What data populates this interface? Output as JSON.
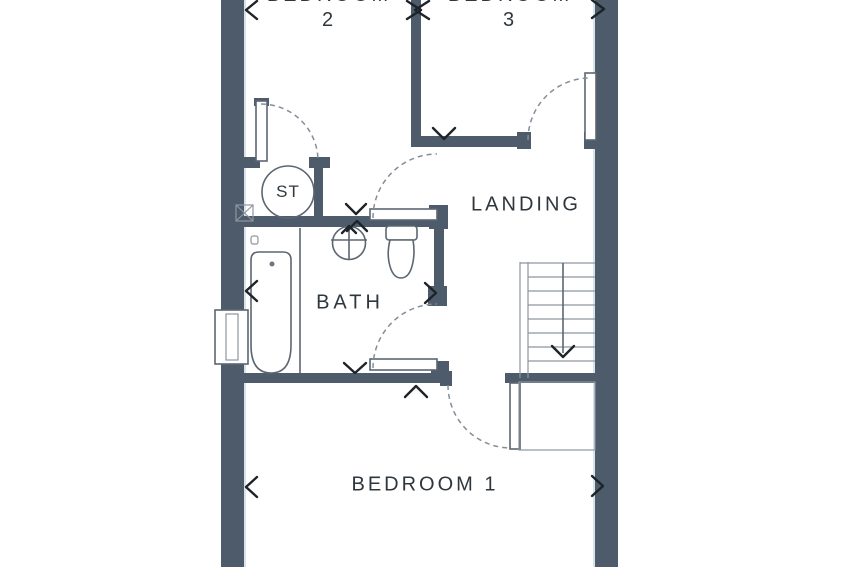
{
  "plan": {
    "type": "floor-plan",
    "rooms": {
      "bedroom2": {
        "name": "BEDROOM",
        "number": "2"
      },
      "bedroom3": {
        "name": "BEDROOM",
        "number": "3"
      },
      "bedroom1": {
        "label": "BEDROOM 1"
      },
      "bath": {
        "label": "BATH"
      },
      "landing": {
        "label": "LANDING"
      },
      "storage": {
        "label": "ST"
      }
    },
    "fixtures": [
      "bathtub",
      "washbasin",
      "toilet",
      "staircase-down",
      "window",
      "storage-cupboard"
    ],
    "colors": {
      "wall": "#4d5b6a",
      "line": "#5b6671",
      "lightline": "#8d97a1",
      "arc": "#848e98",
      "chevron": "#1d2429",
      "text": "#2f373e",
      "edge_highlight": "#d9e4ea",
      "background": "#ffffff"
    }
  }
}
